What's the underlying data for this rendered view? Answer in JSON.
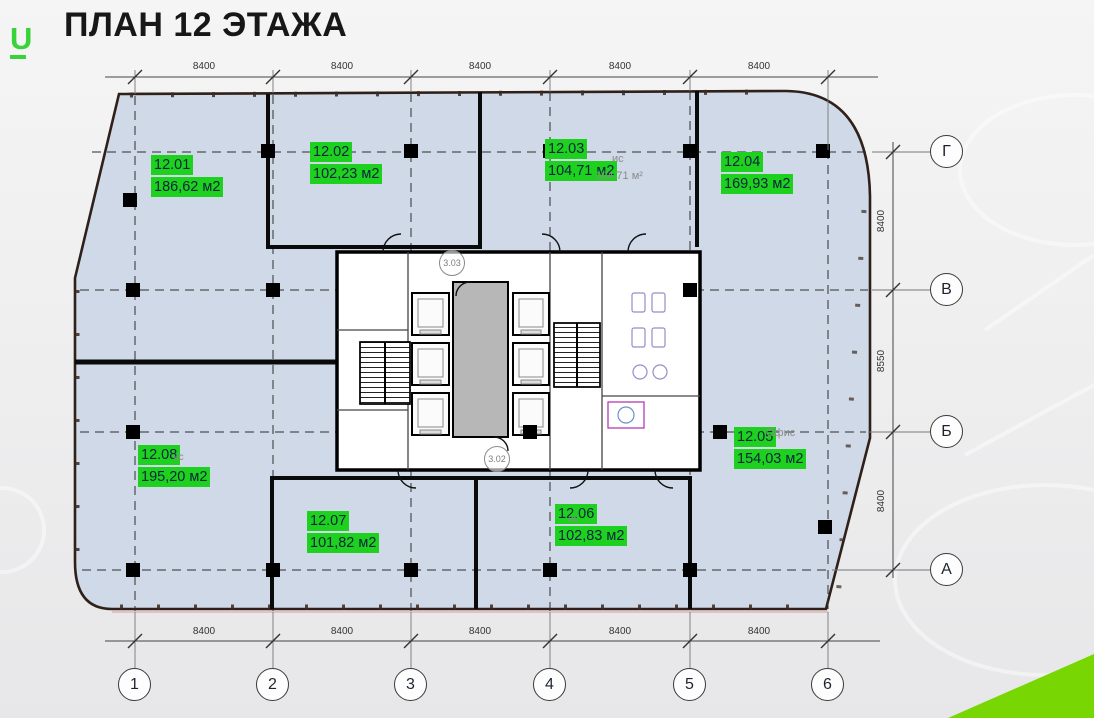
{
  "title": "ПЛАН 12 ЭТАЖА",
  "logo": {
    "letter": "U"
  },
  "colors": {
    "label_green": "#1fd11f",
    "wedge_green": "#78d702",
    "floor_fill": "#cfd9e7",
    "wall_dark": "#30201a"
  },
  "plan": {
    "rooms": [
      {
        "id": "12.01",
        "area": "186,62 м2"
      },
      {
        "id": "12.02",
        "area": "102,23 м2"
      },
      {
        "id": "12.03",
        "area": "104,71 м2"
      },
      {
        "id": "12.04",
        "area": "169,93 м2"
      },
      {
        "id": "12.05",
        "area": "154,03 м2"
      },
      {
        "id": "12.06",
        "area": "102,83 м2"
      },
      {
        "id": "12.07",
        "area": "101,82 м2"
      },
      {
        "id": "12.08",
        "area": "195,20 м2"
      }
    ],
    "ghost_texts": [
      {
        "text": "ис"
      },
      {
        "text": "104.71 м²"
      },
      {
        "text": "Офис"
      },
      {
        "text": "ис"
      },
      {
        "text": "ис"
      }
    ],
    "core_labels": [
      {
        "text": "3.03"
      },
      {
        "text": "3.02"
      }
    ],
    "grid": {
      "cols": [
        "1",
        "2",
        "3",
        "4",
        "5",
        "6"
      ],
      "rows": [
        "Г",
        "В",
        "Б",
        "А"
      ],
      "top_dims": [
        "8400",
        "8400",
        "8400",
        "8400",
        "8400"
      ],
      "bottom_dims": [
        "8400",
        "8400",
        "8400",
        "8400",
        "8400"
      ],
      "right_dims": [
        "8400",
        "8550",
        "8400"
      ]
    }
  }
}
